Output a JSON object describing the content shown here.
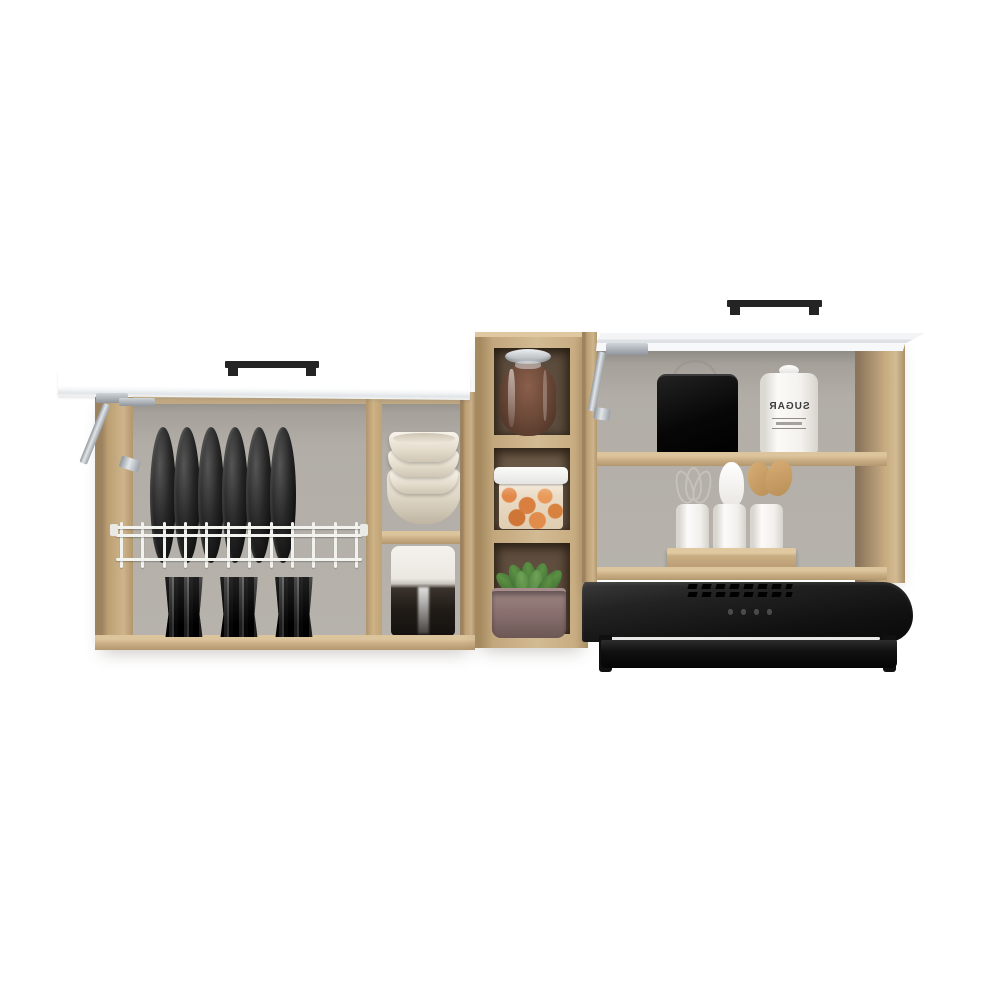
{
  "scene": {
    "kind": "product-photo",
    "subject": "Wall-mounted kitchen cabinet set with open lift-up doors, open shelf tower and black range hood",
    "background_color": "#ffffff"
  },
  "palette": {
    "wood_oak": "#cdb48c",
    "wood_edge_dark": "#a98d66",
    "door_white": "#ffffff",
    "interior_gray": "#b4b0a9",
    "cubby_dark_brown": "#60503f",
    "item_black": "#111111",
    "bowl_cream": "#f0e9dd",
    "snack_orange": "#e08a4c",
    "leaf_green": "#4c7d3b",
    "pot_mauve": "#8a7170",
    "hood_black": "#161616",
    "chrome": "#c9ced3",
    "rack_white": "#f1f1ee"
  },
  "left_cabinet": {
    "door_state": "open",
    "plates": {
      "count": 6,
      "color": "black"
    },
    "dish_rack": {
      "color": "white",
      "vertical_wires": 12
    },
    "cups": {
      "count": 3,
      "color": "black",
      "style": "faceted"
    },
    "bowl_stack": {
      "bowl_count": 3,
      "color": "cream"
    },
    "two_tone_canister": {
      "top_color": "white",
      "bottom_color": "dark brown"
    }
  },
  "center_unit": {
    "cubby_count": 3,
    "glass_jar": {
      "contents_color": "brown",
      "lid": "glass"
    },
    "snack_container": {
      "lid_color": "white",
      "contents_color": "orange"
    },
    "plant": {
      "leaf_count": 8,
      "pot_color": "mauve"
    }
  },
  "right_cabinet": {
    "door_state": "open",
    "bread_bin": {
      "color": "black"
    },
    "sugar_canister": {
      "label": "SUGAR",
      "label_mirrored": true
    },
    "utensil_jars": {
      "count": 3,
      "color": "white"
    },
    "utensils": [
      "whisk",
      "white-spoon",
      "wooden-spoons"
    ],
    "crate_material": "wood"
  },
  "range_hood": {
    "color": "black",
    "button_count": 4,
    "vent_rows": 2,
    "visor": "glass"
  }
}
